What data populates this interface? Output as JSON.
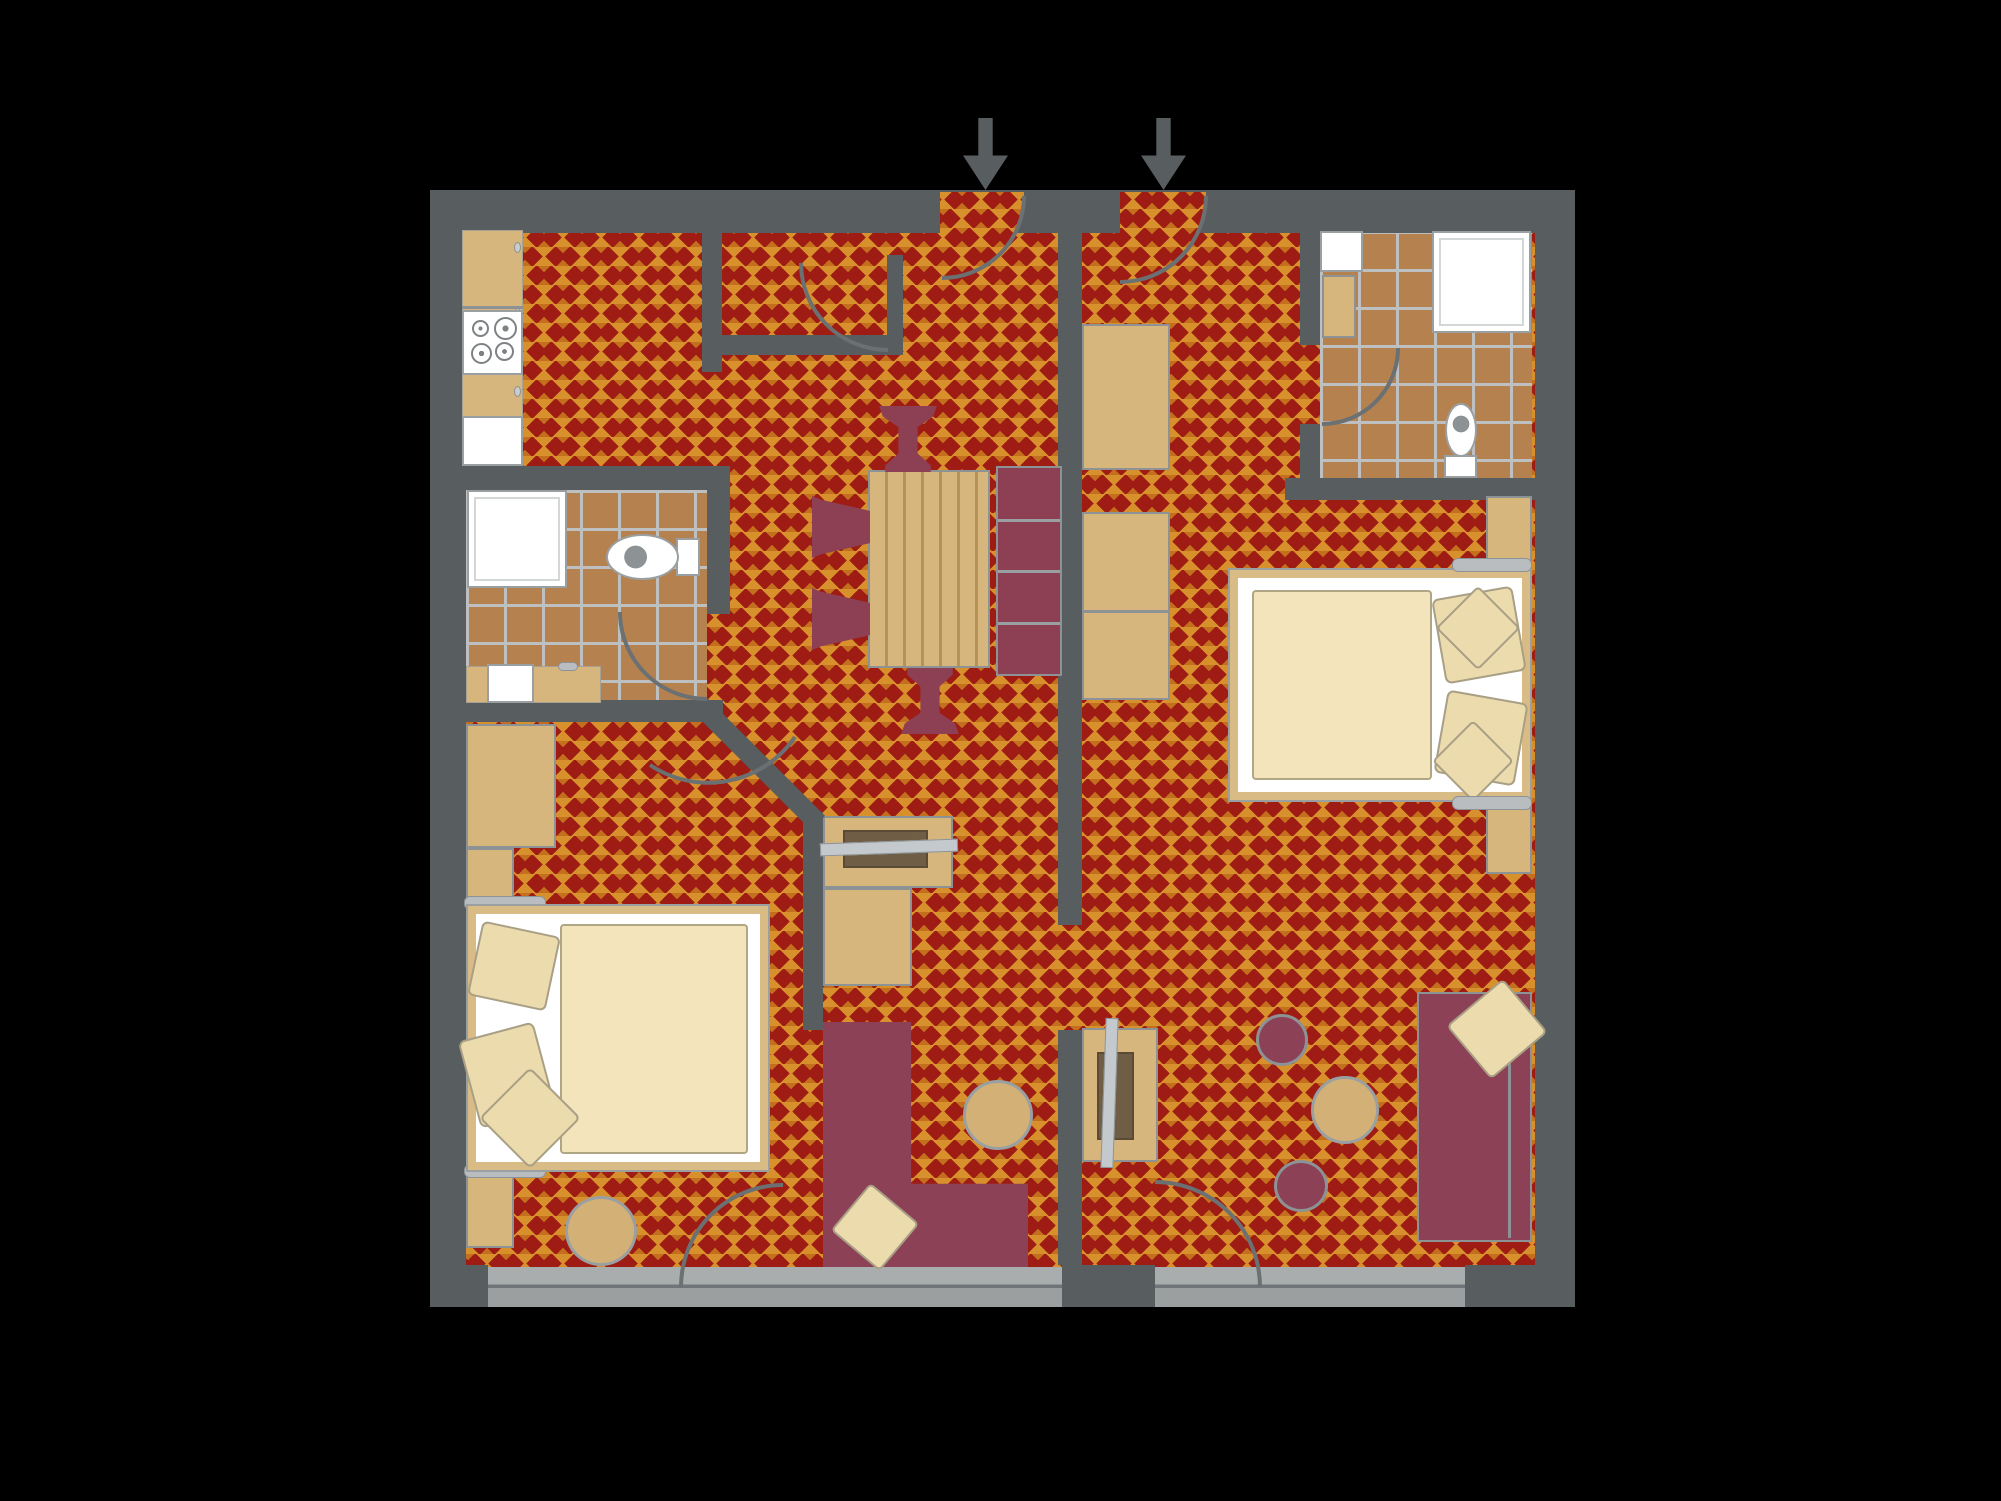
{
  "scene": {
    "background": "#000000",
    "plan": {
      "left": 430,
      "top": 190,
      "width": 1145,
      "height": 1117
    },
    "description-icon-names": [
      "entrance-arrow",
      "door-swing-arc",
      "diagonal-wall"
    ]
  },
  "palette": {
    "carpet_red": "#9e1c13",
    "carpet_diamond_large": "#d8902c",
    "carpet_diamond_small": "#c36f1e",
    "wall_gray": "#585d5f",
    "tile_brown": "#b5824f",
    "tile_grout": "#bdbfc0",
    "furniture_wood": "#d7b67e",
    "upholstery_maroon": "#8c4157",
    "bedding_cream": "#f3e4bc",
    "fixture_white": "#ffffff",
    "balcony_slab": "#a9adad",
    "arc_stroke": "#6b7072"
  },
  "rooms": [
    {
      "name": "kitchen",
      "apartment": "left"
    },
    {
      "name": "entry-closet",
      "apartment": "left"
    },
    {
      "name": "bathroom-left",
      "apartment": "left"
    },
    {
      "name": "dining-living-left",
      "apartment": "left"
    },
    {
      "name": "bedroom-left",
      "apartment": "left"
    },
    {
      "name": "bathroom-right",
      "apartment": "right"
    },
    {
      "name": "bedroom-living-right",
      "apartment": "right"
    },
    {
      "name": "balcony",
      "apartment": "shared"
    }
  ],
  "shapes": [
    {
      "name": "apartment-floor",
      "kind": "floor-carpet",
      "x": 0,
      "y": 0,
      "w": 1145,
      "h": 1117
    },
    {
      "name": "bathroom-left-floor",
      "kind": "floor-tile",
      "x": 36,
      "y": 300,
      "w": 241,
      "h": 210
    },
    {
      "name": "bathroom-right-floor",
      "kind": "floor-tile",
      "x": 890,
      "y": 41,
      "w": 212,
      "h": 247
    },
    {
      "name": "wall-outer-left",
      "kind": "wall",
      "x": 0,
      "y": 0,
      "w": 36,
      "h": 1117
    },
    {
      "name": "wall-outer-top",
      "kind": "wall",
      "x": 0,
      "y": 0,
      "w": 1145,
      "h": 43
    },
    {
      "name": "wall-outer-right",
      "kind": "wall",
      "x": 1105,
      "y": 0,
      "w": 40,
      "h": 1117
    },
    {
      "name": "wall-pillar-bottom-left",
      "kind": "wall",
      "x": 0,
      "y": 1075,
      "w": 58,
      "h": 42
    },
    {
      "name": "wall-pillar-bottom-center",
      "kind": "wall",
      "x": 632,
      "y": 1075,
      "w": 93,
      "h": 42
    },
    {
      "name": "wall-pillar-bottom-right",
      "kind": "wall",
      "x": 1035,
      "y": 1075,
      "w": 110,
      "h": 42
    },
    {
      "name": "wall-closet-left",
      "kind": "wall",
      "x": 272,
      "y": 43,
      "w": 20,
      "h": 139
    },
    {
      "name": "wall-closet-bottom",
      "kind": "wall",
      "x": 272,
      "y": 145,
      "w": 201,
      "h": 20
    },
    {
      "name": "wall-closet-right",
      "kind": "wall",
      "x": 457,
      "y": 65,
      "w": 16,
      "h": 80
    },
    {
      "name": "wall-kitchen-bath",
      "kind": "wall",
      "x": 0,
      "y": 276,
      "w": 300,
      "h": 24
    },
    {
      "name": "wall-bath-right",
      "kind": "wall",
      "x": 277,
      "y": 300,
      "w": 23,
      "h": 124
    },
    {
      "name": "wall-bath-bottom",
      "kind": "wall",
      "x": 0,
      "y": 510,
      "w": 293,
      "h": 22
    },
    {
      "name": "wall-living",
      "kind": "wall",
      "x": 373,
      "y": 622,
      "w": 20,
      "h": 218
    },
    {
      "name": "wall-divider-upper",
      "kind": "wall",
      "x": 628,
      "y": 43,
      "w": 24,
      "h": 692
    },
    {
      "name": "wall-divider-lower",
      "kind": "wall",
      "x": 628,
      "y": 840,
      "w": 24,
      "h": 235
    },
    {
      "name": "wall-rbath-left-upper",
      "kind": "wall",
      "x": 870,
      "y": 43,
      "w": 20,
      "h": 112
    },
    {
      "name": "wall-rbath-left-lower",
      "kind": "wall",
      "x": 870,
      "y": 234,
      "w": 20,
      "h": 56
    },
    {
      "name": "wall-rbath-bottom",
      "kind": "wall",
      "x": 855,
      "y": 288,
      "w": 250,
      "h": 22
    },
    {
      "name": "balcony-slab-left",
      "kind": "slab",
      "x": 58,
      "y": 1077,
      "w": 574,
      "h": 40
    },
    {
      "name": "balcony-slab-right",
      "kind": "slab",
      "x": 725,
      "y": 1077,
      "w": 310,
      "h": 40
    },
    {
      "name": "entry-door-left-swing",
      "kind": "pie",
      "x": 510,
      "y": 2,
      "w": 84,
      "h": 84
    },
    {
      "name": "entry-door-right-swing",
      "kind": "pie",
      "x": 690,
      "y": 2,
      "w": 86,
      "h": 86
    },
    {
      "name": "kitchen-counter",
      "kind": "wood-plain",
      "x": 32,
      "y": 40,
      "w": 61,
      "h": 232
    },
    {
      "name": "kitchen-counter-line",
      "kind": "line-gray",
      "x": 32,
      "y": 116,
      "w": 61,
      "h": 3
    },
    {
      "name": "kitchen-knob",
      "kind": "knob",
      "x": 84,
      "y": 52,
      "w": 7,
      "h": 11
    },
    {
      "name": "kitchen-knob",
      "kind": "knob",
      "x": 84,
      "y": 118,
      "w": 7,
      "h": 11
    },
    {
      "name": "kitchen-knob",
      "kind": "knob",
      "x": 84,
      "y": 196,
      "w": 7,
      "h": 11
    },
    {
      "name": "kitchen-stove",
      "kind": "white-box",
      "x": 32,
      "y": 120,
      "w": 61,
      "h": 65
    },
    {
      "name": "stove-burner",
      "kind": "burner",
      "x": 42,
      "y": 130,
      "w": 17,
      "h": 17
    },
    {
      "name": "stove-burner",
      "kind": "burner",
      "x": 64,
      "y": 127,
      "w": 23,
      "h": 23
    },
    {
      "name": "stove-burner",
      "kind": "burner",
      "x": 41,
      "y": 153,
      "w": 21,
      "h": 21
    },
    {
      "name": "stove-burner",
      "kind": "burner",
      "x": 65,
      "y": 152,
      "w": 19,
      "h": 19
    },
    {
      "name": "kitchen-sink",
      "kind": "white-box",
      "x": 32,
      "y": 226,
      "w": 61,
      "h": 50
    },
    {
      "name": "shower-left",
      "kind": "shower",
      "x": 37,
      "y": 300,
      "w": 100,
      "h": 98
    },
    {
      "name": "toilet-left-tank",
      "kind": "white-box",
      "x": 246,
      "y": 348,
      "w": 24,
      "h": 38
    },
    {
      "name": "toilet-left-bowl",
      "kind": "toilet-bowl-left",
      "x": 176,
      "y": 344,
      "w": 73,
      "h": 46
    },
    {
      "name": "bath-counter-left",
      "kind": "wood-plain",
      "x": 36,
      "y": 476,
      "w": 135,
      "h": 37
    },
    {
      "name": "bath-basin-left",
      "kind": "white-box",
      "x": 57,
      "y": 474,
      "w": 47,
      "h": 39
    },
    {
      "name": "faucet-left",
      "kind": "bracket",
      "x": 128,
      "y": 472,
      "w": 20,
      "h": 9
    },
    {
      "name": "bath-sink-right",
      "kind": "white-box",
      "x": 890,
      "y": 41,
      "w": 43,
      "h": 41
    },
    {
      "name": "bath-cabinet-right",
      "kind": "wood",
      "x": 892,
      "y": 85,
      "w": 34,
      "h": 63
    },
    {
      "name": "shower-right",
      "kind": "shower",
      "x": 1002,
      "y": 41,
      "w": 99,
      "h": 102
    },
    {
      "name": "toilet-right-tank",
      "kind": "white-box",
      "x": 1014,
      "y": 265,
      "w": 33,
      "h": 23
    },
    {
      "name": "toilet-right-bowl",
      "kind": "toilet-bowl-up",
      "x": 1015,
      "y": 213,
      "w": 32,
      "h": 54
    },
    {
      "name": "wardrobe-right-upper",
      "kind": "wood",
      "x": 652,
      "y": 134,
      "w": 88,
      "h": 146
    },
    {
      "name": "wardrobe-right-lower",
      "kind": "wood",
      "x": 652,
      "y": 322,
      "w": 88,
      "h": 188
    },
    {
      "name": "wardrobe-divider-line",
      "kind": "line-gray",
      "x": 652,
      "y": 420,
      "w": 88,
      "h": 3
    },
    {
      "name": "dining-table",
      "kind": "table",
      "x": 438,
      "y": 280,
      "w": 122,
      "h": 198
    },
    {
      "name": "dining-bench",
      "kind": "bench",
      "x": 566,
      "y": 276,
      "w": 66,
      "h": 210
    },
    {
      "name": "dining-chair",
      "kind": "chair-trap",
      "x": 382,
      "y": 306,
      "w": 58,
      "h": 62
    },
    {
      "name": "dining-chair",
      "kind": "chair-trap",
      "x": 382,
      "y": 398,
      "w": 58,
      "h": 62
    },
    {
      "name": "dining-chair",
      "kind": "chair-goblet",
      "x": 448,
      "y": 216,
      "w": 60,
      "h": 66
    },
    {
      "name": "dining-chair",
      "kind": "chair-goblet",
      "x": 470,
      "y": 478,
      "w": 60,
      "h": 66,
      "rot": 180
    },
    {
      "name": "desk-left",
      "kind": "wood",
      "x": 393,
      "y": 626,
      "w": 130,
      "h": 72
    },
    {
      "name": "tv-left",
      "kind": "tv",
      "x": 413,
      "y": 640,
      "w": 85,
      "h": 38
    },
    {
      "name": "tv-screen-left",
      "kind": "screenbar",
      "x": 390,
      "y": 651,
      "w": 138,
      "h": 13,
      "rot": -2
    },
    {
      "name": "cabinet-left",
      "kind": "wood",
      "x": 393,
      "y": 698,
      "w": 89,
      "h": 98
    },
    {
      "name": "sofa-left",
      "kind": "sofa-L",
      "x": 393,
      "y": 832,
      "w": 205,
      "h": 245
    },
    {
      "name": "sofa-pillow",
      "kind": "pillow",
      "x": 413,
      "y": 1006,
      "w": 64,
      "h": 62,
      "rot": 40
    },
    {
      "name": "coffee-table-left",
      "kind": "round-wood",
      "x": 533,
      "y": 890,
      "w": 70,
      "h": 70
    },
    {
      "name": "wardrobe-left",
      "kind": "wood",
      "x": 36,
      "y": 534,
      "w": 90,
      "h": 124
    },
    {
      "name": "headboard-panel",
      "kind": "wood",
      "x": 36,
      "y": 658,
      "w": 48,
      "h": 58
    },
    {
      "name": "headboard-panel",
      "kind": "wood",
      "x": 36,
      "y": 980,
      "w": 48,
      "h": 78
    },
    {
      "name": "bed-bracket",
      "kind": "bracket",
      "x": 34,
      "y": 706,
      "w": 82,
      "h": 14
    },
    {
      "name": "bed-bracket",
      "kind": "bracket",
      "x": 34,
      "y": 974,
      "w": 82,
      "h": 14
    },
    {
      "name": "bed-left",
      "kind": "bedframe",
      "x": 36,
      "y": 714,
      "w": 304,
      "h": 268
    },
    {
      "name": "bed-left-sheet",
      "kind": "white-plain",
      "x": 46,
      "y": 724,
      "w": 284,
      "h": 248
    },
    {
      "name": "bed-left-duvet",
      "kind": "duvet",
      "x": 130,
      "y": 734,
      "w": 188,
      "h": 230
    },
    {
      "name": "bed-pillow",
      "kind": "pillow",
      "x": 44,
      "y": 738,
      "w": 80,
      "h": 76,
      "rot": 12
    },
    {
      "name": "bed-pillow",
      "kind": "pillow",
      "x": 38,
      "y": 840,
      "w": 78,
      "h": 90,
      "rot": -15
    },
    {
      "name": "bed-pillow",
      "kind": "pillow",
      "x": 64,
      "y": 892,
      "w": 72,
      "h": 72,
      "rot": 45
    },
    {
      "name": "stool-left",
      "kind": "round-wood",
      "x": 135,
      "y": 1006,
      "w": 72,
      "h": 70
    },
    {
      "name": "headboard-panel",
      "kind": "wood",
      "x": 1056,
      "y": 306,
      "w": 46,
      "h": 72
    },
    {
      "name": "headboard-panel",
      "kind": "wood",
      "x": 1056,
      "y": 612,
      "w": 46,
      "h": 72
    },
    {
      "name": "bed-right",
      "kind": "bedframe",
      "x": 798,
      "y": 378,
      "w": 304,
      "h": 234
    },
    {
      "name": "bed-right-sheet",
      "kind": "white-plain",
      "x": 808,
      "y": 388,
      "w": 284,
      "h": 214
    },
    {
      "name": "bed-right-duvet",
      "kind": "duvet",
      "x": 822,
      "y": 400,
      "w": 180,
      "h": 190
    },
    {
      "name": "bed-pillow",
      "kind": "pillow",
      "x": 1008,
      "y": 402,
      "w": 82,
      "h": 86,
      "rot": -10
    },
    {
      "name": "bed-pillow",
      "kind": "pillow",
      "x": 1010,
      "y": 506,
      "w": 82,
      "h": 84,
      "rot": 10
    },
    {
      "name": "bed-pillow",
      "kind": "pillow",
      "x": 1018,
      "y": 408,
      "w": 60,
      "h": 60,
      "rot": 45
    },
    {
      "name": "bed-pillow",
      "kind": "pillow",
      "x": 1014,
      "y": 542,
      "w": 58,
      "h": 58,
      "rot": 45
    },
    {
      "name": "bed-bracket",
      "kind": "bracket",
      "x": 1022,
      "y": 368,
      "w": 80,
      "h": 14
    },
    {
      "name": "bed-bracket",
      "kind": "bracket",
      "x": 1022,
      "y": 606,
      "w": 80,
      "h": 14
    },
    {
      "name": "desk-right",
      "kind": "wood",
      "x": 652,
      "y": 838,
      "w": 76,
      "h": 134
    },
    {
      "name": "tv-right",
      "kind": "tv",
      "x": 667,
      "y": 862,
      "w": 37,
      "h": 88
    },
    {
      "name": "tv-screen-right",
      "kind": "screenbar",
      "x": 673,
      "y": 828,
      "w": 13,
      "h": 150,
      "rot": 2
    },
    {
      "name": "sofa-right",
      "kind": "sofa",
      "x": 987,
      "y": 802,
      "w": 115,
      "h": 250
    },
    {
      "name": "sofa-backrest-line",
      "kind": "line-gray",
      "x": 1078,
      "y": 806,
      "w": 3,
      "h": 242
    },
    {
      "name": "sofa-pillow",
      "kind": "pillow",
      "x": 1030,
      "y": 804,
      "w": 74,
      "h": 70,
      "rot": -40
    },
    {
      "name": "coffee-table-right",
      "kind": "round-wood",
      "x": 881,
      "y": 886,
      "w": 68,
      "h": 68
    },
    {
      "name": "pouf",
      "kind": "pouf",
      "x": 826,
      "y": 824,
      "w": 52,
      "h": 52
    },
    {
      "name": "pouf",
      "kind": "pouf",
      "x": 844,
      "y": 970,
      "w": 54,
      "h": 52
    },
    {
      "name": "entrance-arrow",
      "kind": "arrow-down",
      "x": 533,
      "y": -72,
      "w": 45,
      "h": 72
    },
    {
      "name": "entrance-arrow",
      "kind": "arrow-down",
      "x": 711,
      "y": -72,
      "w": 45,
      "h": 72
    }
  ],
  "svg_overlay": {
    "stroke": "#6b7072",
    "stroke_width": 4,
    "door_arcs": [
      {
        "name": "entry-door-left-arc",
        "d": "M 594 6 A 82 82 0 0 1 512 88"
      },
      {
        "name": "entry-door-right-arc",
        "d": "M 776 6 A 86 86 0 0 1 690 92"
      },
      {
        "name": "closet-door-arc",
        "d": "M 371 73 A 87 87 0 0 0 458 160"
      },
      {
        "name": "bathroom-left-door-arc",
        "d": "M 190 422 A 87 87 0 0 0 277 509"
      },
      {
        "name": "bedroom-left-door-arc",
        "d": "M 220 575 A 105 105 0 0 0 365 547"
      },
      {
        "name": "bathroom-right-door-arc",
        "d": "M 892 234 A 76 76 0 0 0 968 158"
      },
      {
        "name": "balcony-door-left-arc",
        "d": "M 251 1097 A 102 102 0 0 1 353 995"
      },
      {
        "name": "balcony-door-right-arc",
        "d": "M 725 992 A 105 105 0 0 1 830 1097"
      }
    ],
    "diagonal_walls": [
      {
        "name": "wall-bedroom-diagonal",
        "x1": 270,
        "y1": 515,
        "x2": 388,
        "y2": 633,
        "width": 20,
        "color": "#585d5f"
      }
    ]
  }
}
